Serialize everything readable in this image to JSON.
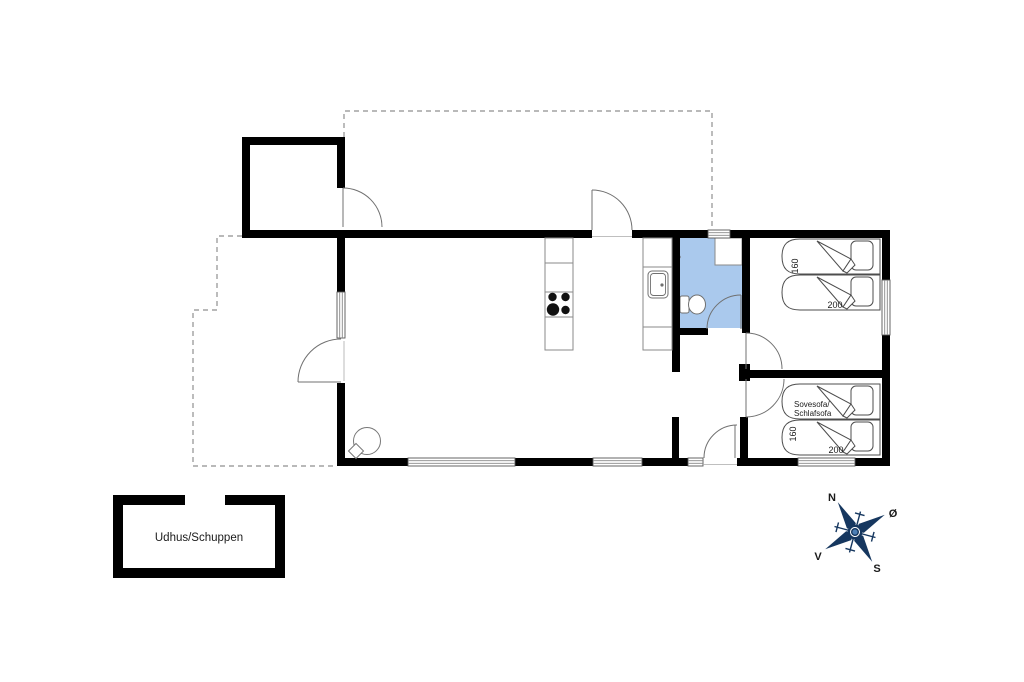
{
  "plan": {
    "labels": {
      "outbuilding": "Udhus/Schuppen",
      "sofa_bed_line1": "Sovesofa/",
      "sofa_bed_line2": "Schlafsofa",
      "bed_top_width": "160",
      "bed_top_length": "200",
      "bed_bottom_width": "160",
      "bed_bottom_length": "200"
    },
    "compass": {
      "north": "N",
      "east": "Ø",
      "south": "S",
      "west": "V"
    },
    "colors": {
      "wall": "#000000",
      "bathroom_fill": "#aac9ed",
      "compass": "#16375f",
      "dashed_line": "#8f8f8f",
      "fixture_stroke": "#707070"
    }
  }
}
